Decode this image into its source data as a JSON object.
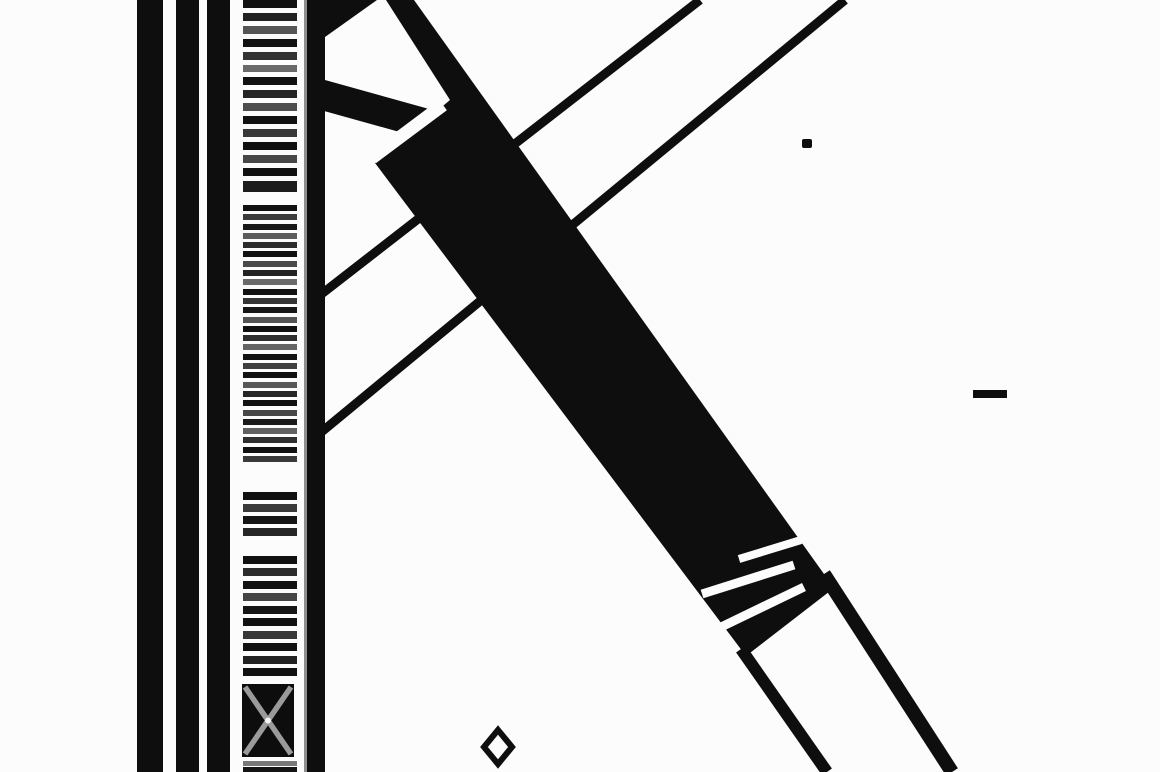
{
  "canvas": {
    "width": 1160,
    "height": 772,
    "background": "#fcfcfc",
    "ink": "#0e0e0e"
  },
  "vertical_bars": [
    {
      "x": 137,
      "w": 26
    },
    {
      "x": 176,
      "w": 23
    },
    {
      "x": 207,
      "w": 23
    },
    {
      "x": 307,
      "w": 18
    }
  ],
  "gray_rule": {
    "x": 304,
    "w": 3,
    "color": "#8f8f8f"
  },
  "barcode": {
    "x": 240,
    "w": 58,
    "stripe_x": 243,
    "stripe_w": 54,
    "stripes": [
      [
        0,
        8,
        "#111"
      ],
      [
        13,
        8,
        "#222"
      ],
      [
        26,
        8,
        "#555"
      ],
      [
        39,
        8,
        "#111"
      ],
      [
        52,
        8,
        "#333"
      ],
      [
        65,
        7,
        "#696969"
      ],
      [
        77,
        8,
        "#111"
      ],
      [
        90,
        8,
        "#242424"
      ],
      [
        103,
        8,
        "#4e4e4e"
      ],
      [
        116,
        8,
        "#111"
      ],
      [
        129,
        8,
        "#383838"
      ],
      [
        142,
        8,
        "#111"
      ],
      [
        155,
        8,
        "#474747"
      ],
      [
        168,
        8,
        "#111"
      ],
      [
        181,
        11,
        "#1c1c1c"
      ],
      [
        205,
        6,
        "#111"
      ],
      [
        214,
        6,
        "#3c3c3c"
      ],
      [
        224,
        6,
        "#191919"
      ],
      [
        233,
        6,
        "#5c5c5c"
      ],
      [
        242,
        6,
        "#2b2b2b"
      ],
      [
        251,
        6,
        "#111"
      ],
      [
        261,
        6,
        "#4a4a4a"
      ],
      [
        270,
        6,
        "#222"
      ],
      [
        279,
        6,
        "#6a6a6a"
      ],
      [
        289,
        6,
        "#111"
      ],
      [
        298,
        6,
        "#353535"
      ],
      [
        307,
        6,
        "#171717"
      ],
      [
        317,
        6,
        "#555"
      ],
      [
        326,
        6,
        "#111"
      ],
      [
        335,
        6,
        "#2e2e2e"
      ],
      [
        344,
        6,
        "#646464"
      ],
      [
        354,
        6,
        "#131313"
      ],
      [
        363,
        6,
        "#404040"
      ],
      [
        372,
        6,
        "#111"
      ],
      [
        382,
        6,
        "#585858"
      ],
      [
        391,
        6,
        "#262626"
      ],
      [
        400,
        6,
        "#111"
      ],
      [
        410,
        6,
        "#474747"
      ],
      [
        419,
        6,
        "#1a1a1a"
      ],
      [
        428,
        6,
        "#616161"
      ],
      [
        437,
        6,
        "#2f2f2f"
      ],
      [
        447,
        6,
        "#111"
      ],
      [
        456,
        6,
        "#3a3a3a"
      ],
      [
        492,
        8,
        "#111"
      ],
      [
        504,
        8,
        "#3a3a3a"
      ],
      [
        516,
        8,
        "#151515"
      ],
      [
        528,
        8,
        "#262626"
      ],
      [
        556,
        8,
        "#111"
      ],
      [
        568,
        8,
        "#2c2c2c"
      ],
      [
        581,
        8,
        "#111"
      ],
      [
        593,
        8,
        "#454545"
      ],
      [
        606,
        8,
        "#151515"
      ],
      [
        618,
        8,
        "#111"
      ],
      [
        631,
        8,
        "#383838"
      ],
      [
        643,
        8,
        "#111"
      ],
      [
        656,
        8,
        "#222"
      ],
      [
        668,
        8,
        "#111"
      ],
      [
        761,
        5,
        "#787878"
      ],
      [
        767,
        5,
        "#141414"
      ]
    ],
    "crossed_box": {
      "x": 242,
      "y": 684,
      "w": 52,
      "h": 73,
      "fill": "#0d0d0d",
      "cross_color": "#9a9a9a",
      "cross_width": 5.5,
      "center_dot": "#f5f5f5"
    }
  },
  "diagonals": {
    "thin_lines": [
      {
        "x1": 319,
        "y1": 296,
        "x2": 700,
        "y2": 0,
        "w": 9
      },
      {
        "x1": 319,
        "y1": 434,
        "x2": 845,
        "y2": 0,
        "w": 9
      }
    ],
    "corner_triangle": [
      [
        318,
        0
      ],
      [
        377,
        0
      ],
      [
        318,
        42
      ]
    ],
    "strut": {
      "x1": 312,
      "y1": 92,
      "x2": 452,
      "y2": 131,
      "w": 30
    },
    "beam_polygon": [
      [
        386,
        0
      ],
      [
        414,
        0
      ],
      [
        834,
        588
      ],
      [
        746,
        656
      ],
      [
        375,
        163
      ],
      [
        450,
        100
      ]
    ],
    "white_slot": {
      "x1": 372,
      "y1": 158,
      "x2": 443,
      "y2": 105,
      "w": 13
    },
    "white_slashes": [
      {
        "x1": 739,
        "y1": 559,
        "x2": 801,
        "y2": 540,
        "w": 8
      },
      {
        "x1": 702,
        "y1": 594,
        "x2": 794,
        "y2": 565,
        "w": 9
      },
      {
        "x1": 717,
        "y1": 629,
        "x2": 804,
        "y2": 587,
        "w": 9
      }
    ],
    "tail_lines": [
      {
        "x1": 741,
        "y1": 649,
        "x2": 827,
        "y2": 772,
        "w": 12
      },
      {
        "x1": 824,
        "y1": 574,
        "x2": 952,
        "y2": 772,
        "w": 14
      }
    ]
  },
  "marks": {
    "dot": {
      "x": 802,
      "y": 139,
      "w": 10,
      "h": 9
    },
    "dash": {
      "x": 973,
      "y": 390,
      "w": 34,
      "h": 8
    },
    "diamond": {
      "cx": 498,
      "cy": 747,
      "rx": 14,
      "ry": 17,
      "stroke_w": 6
    }
  }
}
